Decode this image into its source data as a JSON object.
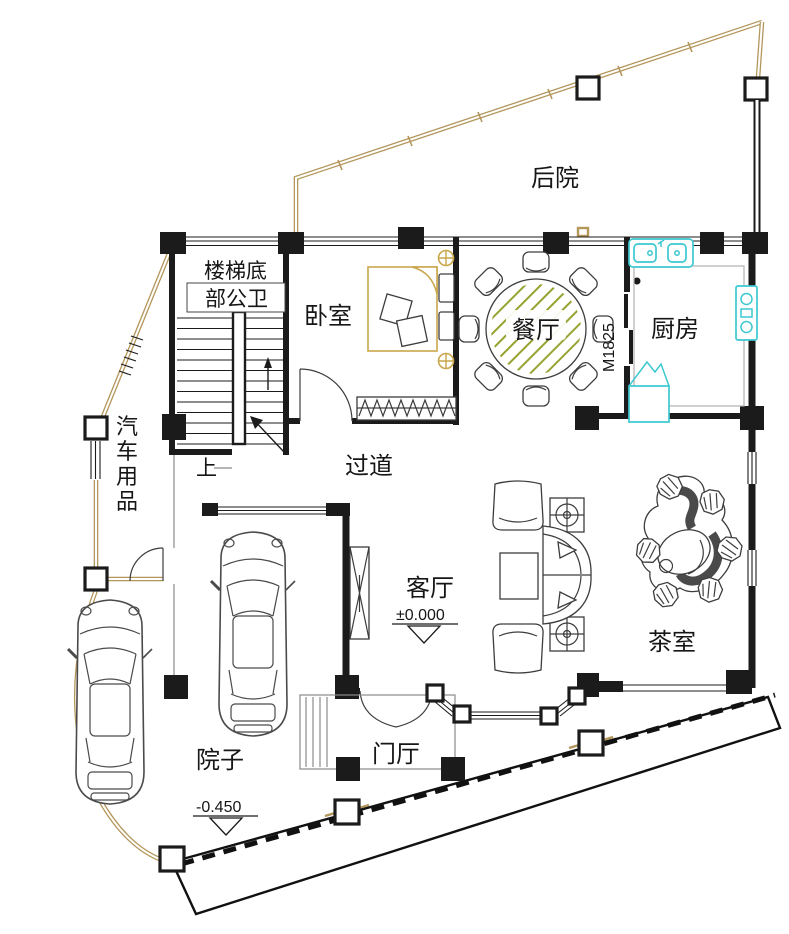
{
  "plan": {
    "kind": "residential floor plan",
    "labels": {
      "backyard": "后院",
      "stair_bath_line1": "楼梯底",
      "stair_bath_line2": "部公卫",
      "bedroom": "卧室",
      "dining": "餐厅",
      "door_code": "M1825",
      "kitchen": "厨房",
      "car_supplies": [
        "汽",
        "车",
        "用",
        "品"
      ],
      "stairs_up": "上",
      "corridor": "过道",
      "living": "客厅",
      "living_elevation": "±0.000",
      "tea_room": "茶室",
      "foyer": "门厅",
      "yard": "院子",
      "yard_elevation": "-0.450"
    },
    "colors": {
      "wall": "#1b1b1b",
      "fence": "#b3965a",
      "fixture": "#3cc8d0",
      "bed": "#c9a64b",
      "table_hatch": "#97a230",
      "car": "#4a4a4a"
    }
  }
}
